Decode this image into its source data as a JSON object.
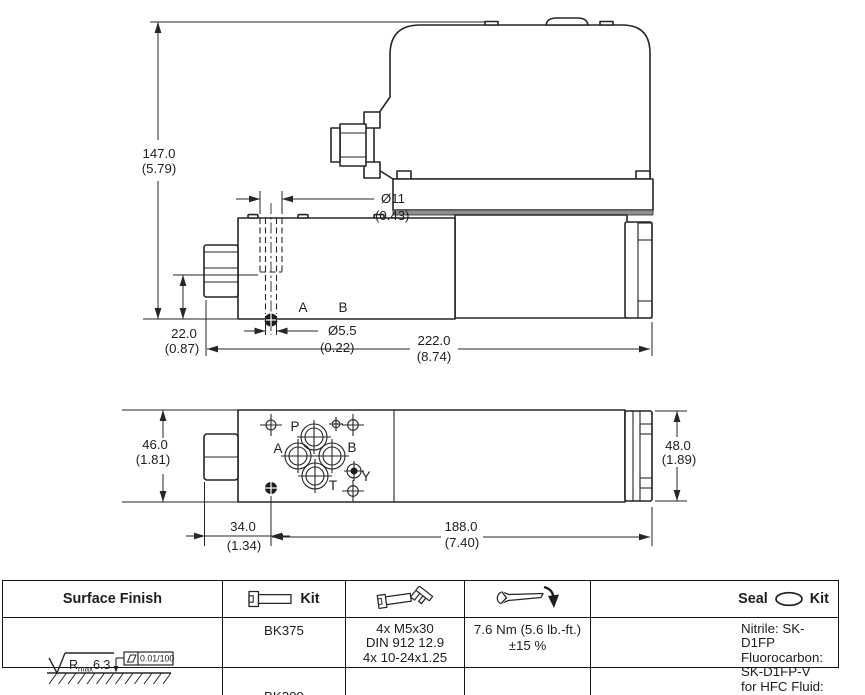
{
  "ink": "#262626",
  "drawing": {
    "side_view": {
      "dim_height": [
        "147.0",
        "(5.79)"
      ],
      "dim_hole_top": [
        "Ø11",
        "(0.43)"
      ],
      "dim_port_axis": [
        "22.0",
        "(0.87)"
      ],
      "dim_hole_bottom": [
        "Ø5.5",
        "(0.22)"
      ],
      "dim_length": [
        "222.0",
        "(8.74)"
      ],
      "labels": {
        "port_a": "A",
        "port_b": "B"
      }
    },
    "bottom_view": {
      "dim_width": [
        "46.0",
        "(1.81)"
      ],
      "dim_nut_offset": [
        "34.0",
        "(1.34)"
      ],
      "dim_body_length": [
        "188.0",
        "(7.40)"
      ],
      "dim_end_width": [
        "48.0",
        "(1.89)"
      ],
      "labels": {
        "port_p": "P",
        "port_a": "A",
        "port_b": "B",
        "port_t": "T",
        "port_y": "Y"
      }
    }
  },
  "table": {
    "headers": {
      "surface_finish": "Surface Finish",
      "bolt_kit_label": "Kit",
      "seal_label": "Seal",
      "seal_kit_label": "Kit"
    },
    "cells": {
      "surface_finish_symbol": {
        "r": "R",
        "sub": "max",
        "value": "6.3",
        "flatness": "0.01/100"
      },
      "bolt_kit": [
        "BK375",
        "BK209"
      ],
      "bolt_spec": [
        "4x M5x30",
        "DIN 912 12.9",
        "4x 10-24x1.25"
      ],
      "torque": [
        "7.6 Nm (5.6 lb.-ft.)",
        "±15 %"
      ],
      "seal_kit": [
        "Nitrile: SK-D1FP",
        "Fluorocarbon: SK-D1FP-V",
        "for HFC Fluid: SK-D1FP-H"
      ]
    }
  }
}
